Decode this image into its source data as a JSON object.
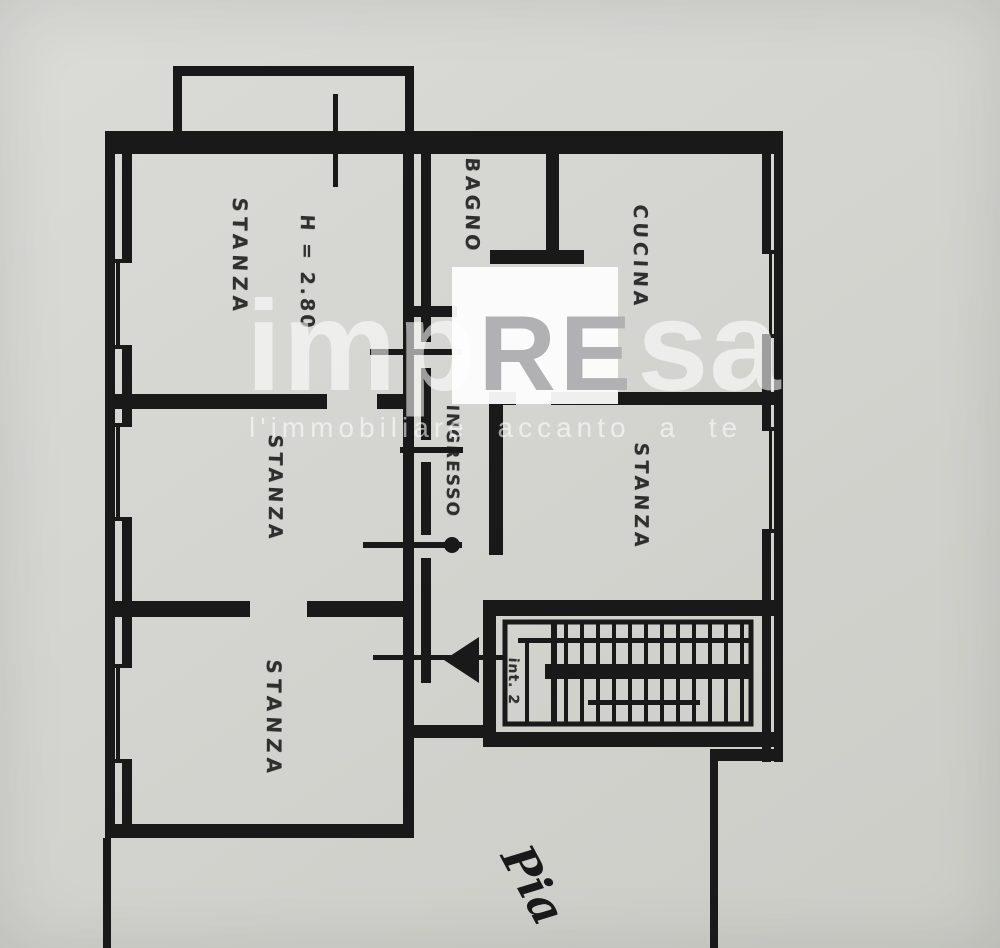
{
  "theme": {
    "ink": "#191919",
    "paper": "#d4d4d0",
    "paper_light": "#dbdbd7",
    "paper_dark": "#cccdc7",
    "watermark": "rgba(255,255,255,0.58)",
    "watermark_re": "#b1b1b4",
    "watermark_block": "#fdfdfd"
  },
  "floorplan": {
    "labels": {
      "stanza_top_left": "STANZA",
      "ceiling_height": "H = 2.80",
      "bagno": "BAGNO",
      "cucina": "CUCINA",
      "ingresso": "INGRESSO",
      "stanza_right": "STANZA",
      "stanza_middle_left": "STANZA",
      "stanza_bottom_left": "STANZA",
      "stair_unit": "int. 2",
      "bottom_note": "Pia"
    }
  },
  "watermark": {
    "logo_part1": "imp",
    "logo_part2": "RE",
    "logo_part3": "sa",
    "tagline": "l'immobiliare accanto a te"
  }
}
